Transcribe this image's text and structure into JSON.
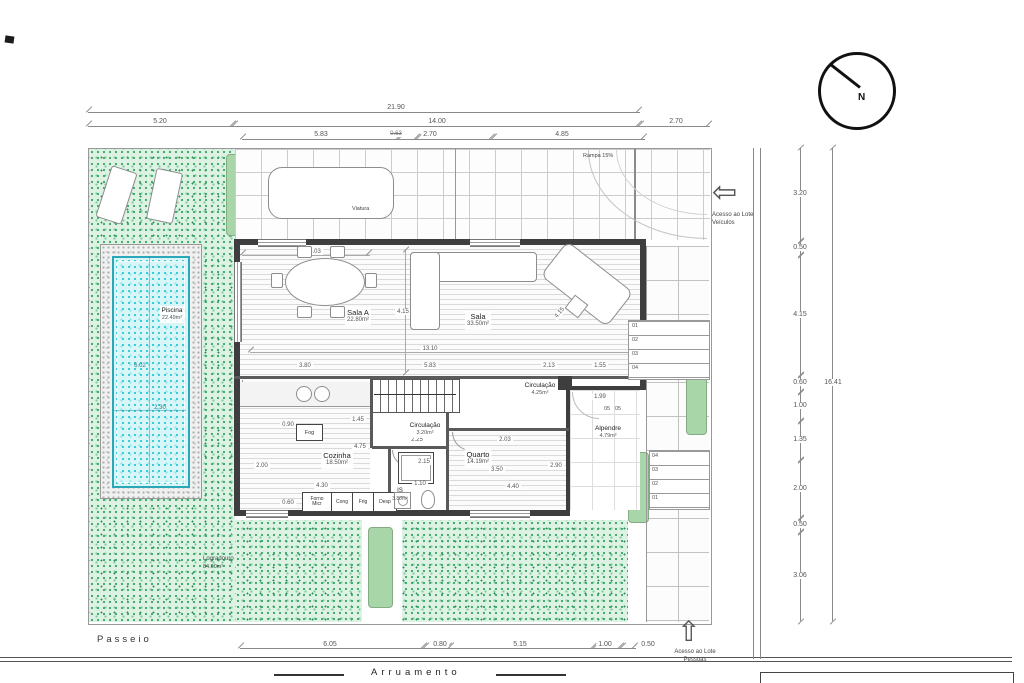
{
  "colors": {
    "grass": "#3fa86b",
    "water": "#2fc9d6",
    "wall": "#3e3e3e",
    "planter": "#d8eed8"
  },
  "compass": {
    "label": "N"
  },
  "header_dims": {
    "total": "21.90",
    "row2": [
      "5.20",
      "14.00",
      "2.70"
    ],
    "row3": [
      "5.83",
      "0.63",
      "2.70",
      "4.85"
    ]
  },
  "right_dims": {
    "segments": [
      "3.20",
      "0.50",
      "4.15",
      "0.60",
      "1.00",
      "1.35",
      "2.00",
      "0.50",
      "3.06"
    ],
    "total": "16.41"
  },
  "bottom_dims": [
    "6.05",
    "0.80",
    "5.15",
    "1.00",
    "0.50"
  ],
  "site": {
    "passeio": "Passeio",
    "arruamento": "Arruamento",
    "rampa": "Rampa 15%",
    "viatura": "Viatura",
    "access_vehicles": {
      "line1": "Acesso ao Lote",
      "line2": "Veículos"
    },
    "access_people": {
      "line1": "Acesso ao Lote",
      "line2": "Pessoas"
    },
    "logradouro": {
      "name": "Logradouro",
      "area": "84.00m²"
    }
  },
  "rooms": {
    "piscina": {
      "name": "Piscina",
      "area": "22.49m²",
      "length": "6.02",
      "width": "2.30"
    },
    "sala_a": {
      "name": "Sala A",
      "area": "22.80m²"
    },
    "sala": {
      "name": "Sala",
      "area": "33.50m²"
    },
    "cozinha": {
      "name": "Cozinha",
      "area": "18.50m²"
    },
    "quarto": {
      "name": "Quarto",
      "area": "14.19m²"
    },
    "is": {
      "name": "IS",
      "area": "3.80m²"
    },
    "circulacao_piso": {
      "name": "Circulação",
      "area": "3.20m²"
    },
    "circulacao_sup": {
      "name": "Circulação",
      "area": "4.25m²"
    },
    "alpendre": {
      "name": "Alpendre",
      "area": "4.79m²"
    }
  },
  "interior_dims": {
    "sala_a_w": "5.03",
    "sala_a_h": "4.15",
    "sala_diag": "4.15",
    "living_total": "13.10",
    "seg_380": "3.80",
    "seg_583": "5.83",
    "seg_213": "2.13",
    "seg_155": "1.55",
    "stair_w": "0.90",
    "circ_sup_w": "1.99",
    "hall_a": "2.25",
    "hall_b": "2.03",
    "kitchen_145": "1.45",
    "kitchen_090": "0.90",
    "kitchen_475": "4.75",
    "kitchen_200": "2.00",
    "kitchen_430": "4.30",
    "kitchen_060": "0.60",
    "shower": "2.15",
    "is_w": "1.10",
    "quarto_350": "3.50",
    "quarto_290": "2.90",
    "quarto_440": "4.40"
  },
  "kitchen_items": {
    "fog": "Fog",
    "forno": "Forno",
    "micr": "Micr",
    "cong": "Cong",
    "frig": "Frig",
    "desp": "Desp"
  },
  "steps": {
    "upper": [
      "01",
      "02",
      "03",
      "04"
    ],
    "lower": [
      "04",
      "03",
      "02",
      "01"
    ],
    "mid": "05"
  }
}
